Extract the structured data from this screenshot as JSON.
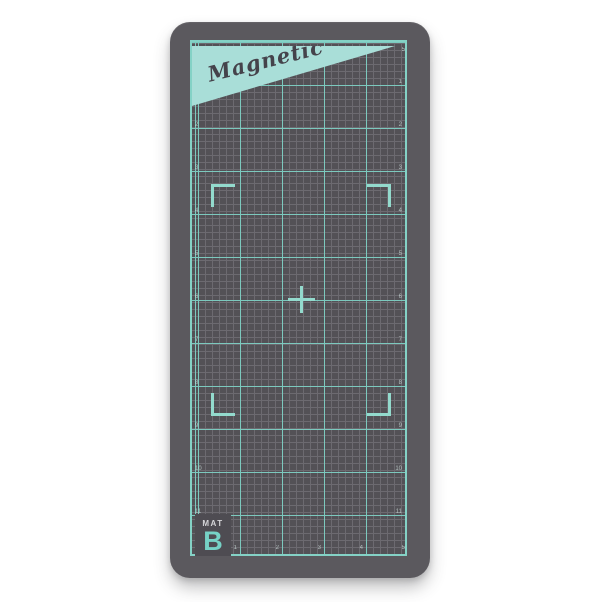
{
  "product": {
    "banner_label": "Magnetic",
    "label_prefix": "MAT",
    "label_letter": "B"
  },
  "ruler": {
    "top_numbers": [
      "1",
      "2",
      "3",
      "4",
      "5"
    ],
    "bottom_numbers": [
      "1",
      "2",
      "3",
      "4",
      "5"
    ],
    "left_numbers": [
      "1",
      "2",
      "3",
      "4",
      "5",
      "6",
      "7",
      "8",
      "9",
      "10",
      "11"
    ],
    "right_numbers": [
      "1",
      "2",
      "3",
      "4",
      "5",
      "6",
      "7",
      "8",
      "9",
      "10",
      "11"
    ]
  },
  "colors": {
    "page_bg": "#ffffff",
    "mat_body": "#5b595e",
    "grid_bg": "#535156",
    "grid_minor": "#6c6a70",
    "grid_major": "#7cc9be",
    "accent_bright": "#93dacd",
    "border_teal": "#84d2c6",
    "banner_fill": "#a9ded8",
    "banner_text": "#45434b",
    "label_bg": "#4e4c52",
    "label_prefix_color": "#d6d6d9",
    "label_letter_color": "#76d2c6",
    "ruler_number_color": "#cfe0dd"
  }
}
